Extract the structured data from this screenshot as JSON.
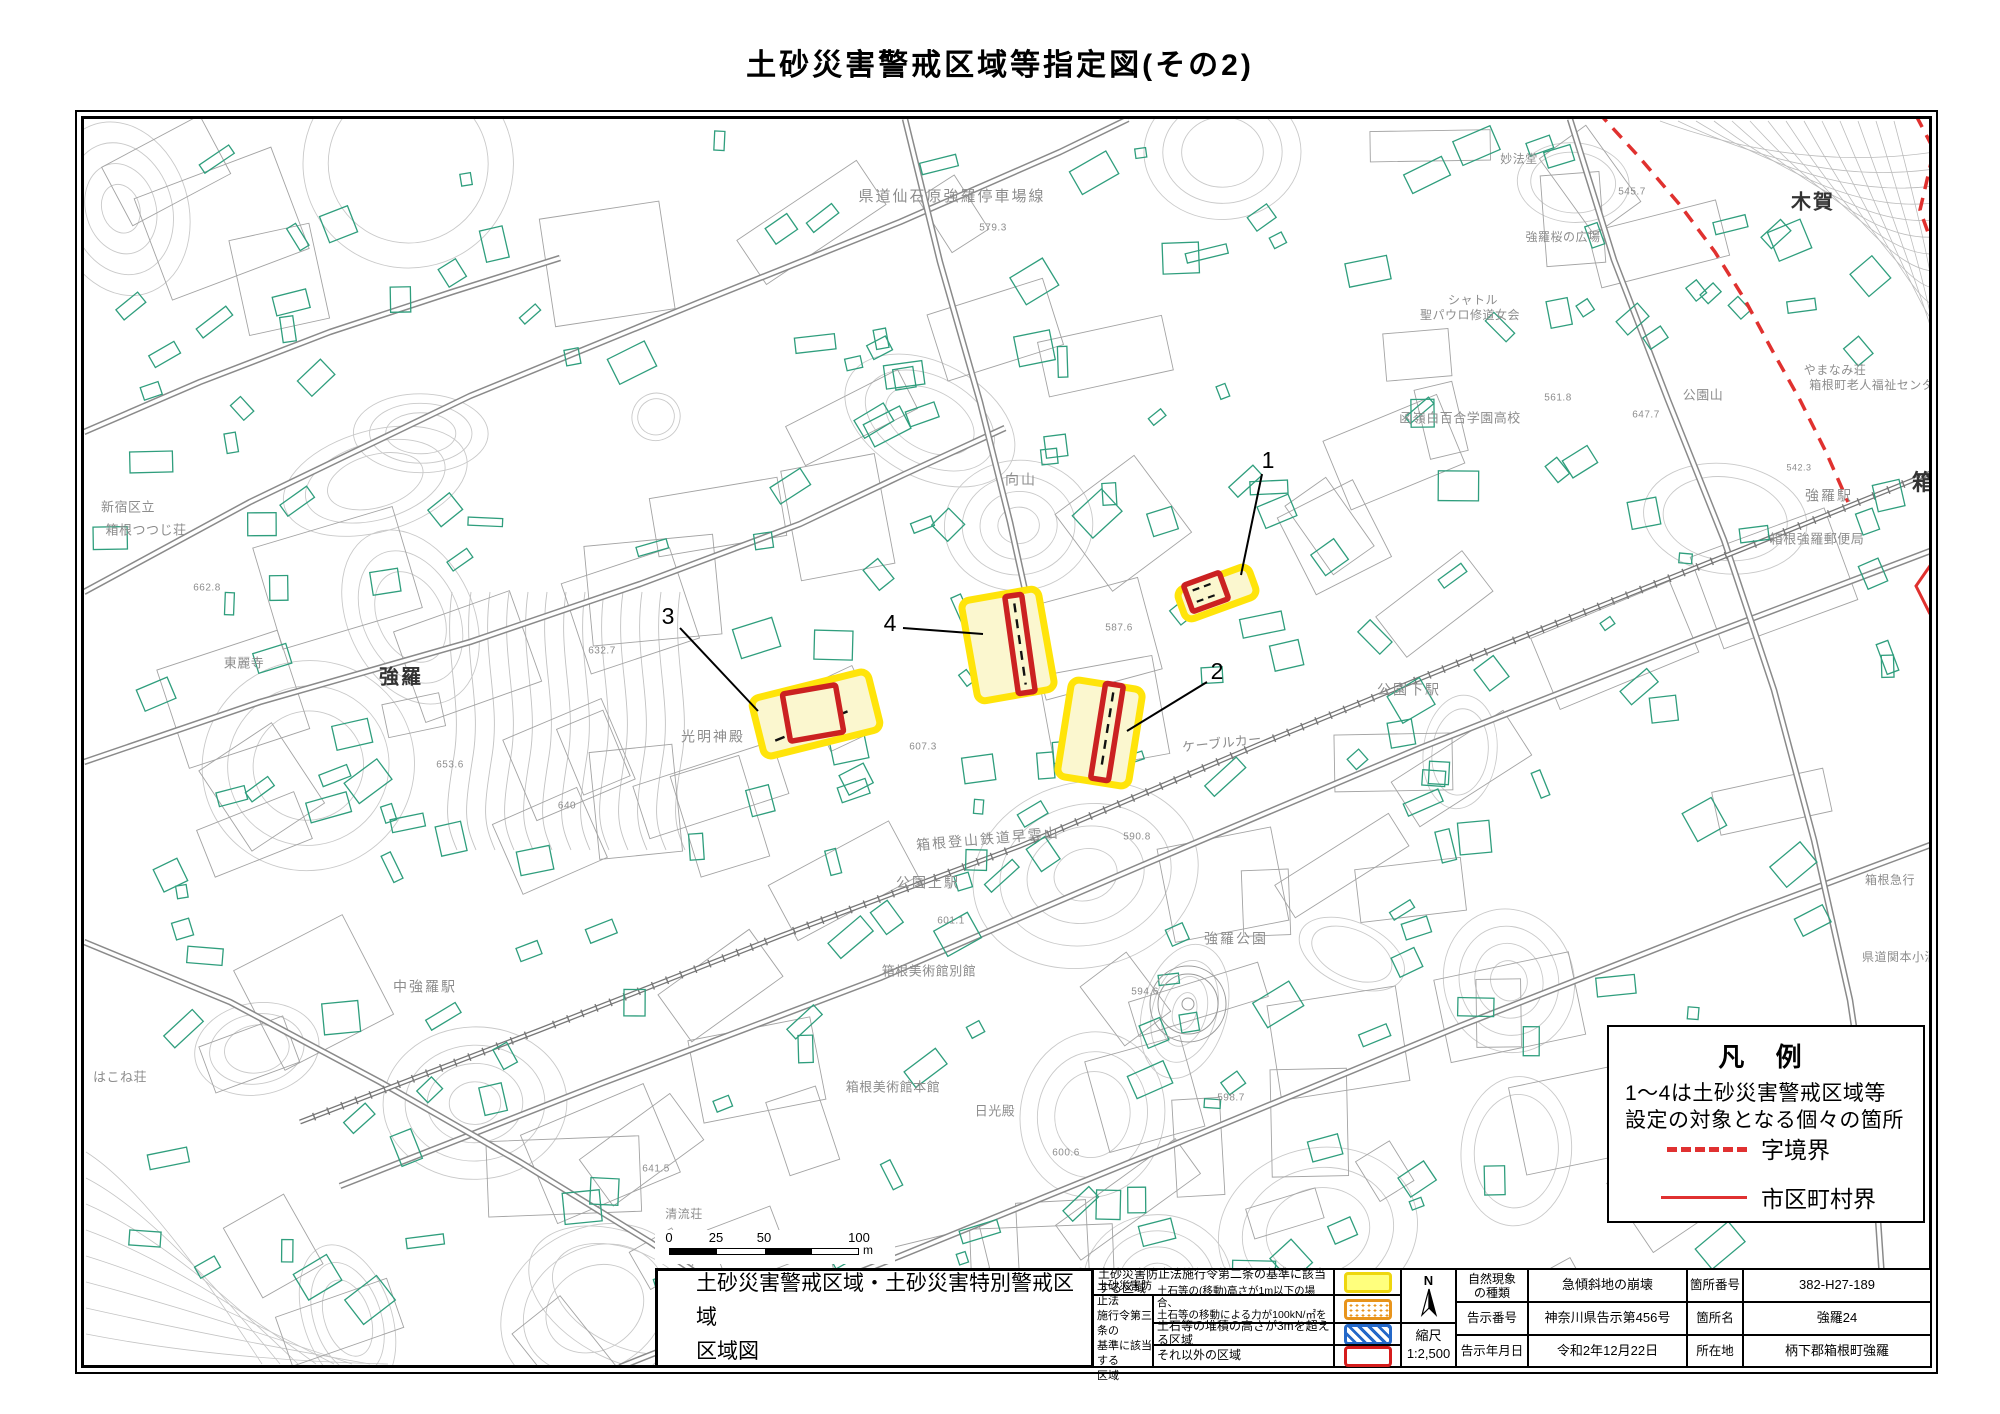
{
  "title": "土砂災害警戒区域等指定図(その2)",
  "legend_box": {
    "title": "凡 例",
    "note_lines": [
      "1〜4は土砂災害警戒区域等",
      "設定の対象となる個々の箇所"
    ],
    "items": [
      {
        "label": "字境界",
        "line": "dashed",
        "color": "#e03131"
      },
      {
        "label": "市区町村界",
        "line": "solid",
        "color": "#e03131"
      }
    ]
  },
  "scale_bar": {
    "t0": "0",
    "t1": "25",
    "t2": "50",
    "t3": "100",
    "unit": "m"
  },
  "info_table": {
    "map_title_lines": [
      "土砂災害警戒区域・土砂災害特別警戒区域",
      "区域図"
    ],
    "article2_label": "土砂災害防止法施行令第二条の基準に該当する区域",
    "article3_group_lines": [
      "土砂災害防止法",
      "施行令第三条の",
      "基準に該当する",
      "区域"
    ],
    "article3_rows": [
      {
        "lines": [
          "土石等の(移動)高さが1m以下の場合、",
          "土石等の移動による力が100kN/㎡を超える区域"
        ],
        "swatch": "orange-dots"
      },
      {
        "lines": [
          "土石等の堆積の高さが3mを超える区域"
        ],
        "swatch": "blue-hatch"
      },
      {
        "lines": [
          "それ以外の区域"
        ],
        "swatch": "red-outline"
      }
    ],
    "compass_label": "N",
    "scale_label": "縮尺",
    "scale_value": "1:2,500",
    "details": [
      {
        "label1_lines": [
          "自然現象",
          "の種類"
        ],
        "value1": "急傾斜地の崩壊",
        "label2": "箇所番号",
        "value2": "382-H27-189"
      },
      {
        "label1_lines": [
          "告示番号"
        ],
        "value1": "神奈川県告示第456号",
        "label2": "箇所名",
        "value2": "強羅24"
      },
      {
        "label1_lines": [
          "告示年月日"
        ],
        "value1": "令和2年12月22日",
        "label2": "所在地",
        "value2": "柄下郡箱根町強羅"
      }
    ]
  },
  "map": {
    "colors": {
      "warning_border": "#ffe40a",
      "warning_fill": "#fbf7cf",
      "special_border": "#cb2121",
      "building": "#2f9e7d",
      "contour": "#c9c9c9",
      "road": "#8a8a8a",
      "boundary_red": "#e0312f",
      "label_gray": "#8d8d8d"
    },
    "area_labels": [
      {
        "t": "県道仙石原強羅停車場線",
        "x": 952,
        "y": 197,
        "s": 15
      },
      {
        "t": "579.3",
        "x": 993,
        "y": 228,
        "s": 10
      },
      {
        "t": "木賀",
        "x": 1813,
        "y": 203,
        "s": 20,
        "c": "#333333",
        "b": 1
      },
      {
        "t": "妙法堂",
        "x": 1519,
        "y": 160,
        "s": 12
      },
      {
        "t": "強羅桜の広場",
        "x": 1563,
        "y": 238,
        "s": 12
      },
      {
        "t": "シャトル",
        "x": 1473,
        "y": 301,
        "s": 12
      },
      {
        "t": "聖パウロ修道女会",
        "x": 1470,
        "y": 316,
        "s": 12
      },
      {
        "t": "新宿区立",
        "x": 128,
        "y": 508,
        "s": 13
      },
      {
        "t": "箱根つつじ荘",
        "x": 146,
        "y": 531,
        "s": 13
      },
      {
        "t": "東麗寺",
        "x": 244,
        "y": 664,
        "s": 13
      },
      {
        "t": "662.8",
        "x": 207,
        "y": 588,
        "s": 10
      },
      {
        "t": "強羅",
        "x": 401,
        "y": 678,
        "s": 20,
        "c": "#333333",
        "b": 1
      },
      {
        "t": "光明神殿",
        "x": 713,
        "y": 738,
        "s": 14
      },
      {
        "t": "向山",
        "x": 1021,
        "y": 481,
        "s": 14
      },
      {
        "t": "函嶺白百合学園高校",
        "x": 1460,
        "y": 419,
        "s": 13
      },
      {
        "t": "公園山",
        "x": 1703,
        "y": 396,
        "s": 13
      },
      {
        "t": "647.7",
        "x": 1646,
        "y": 415,
        "s": 10
      },
      {
        "t": "561.8",
        "x": 1558,
        "y": 398,
        "s": 10
      },
      {
        "t": "545.7",
        "x": 1632,
        "y": 192,
        "s": 10
      },
      {
        "t": "やまなみ荘",
        "x": 1835,
        "y": 371,
        "s": 12
      },
      {
        "t": "箱根町老人福祉センター",
        "x": 1878,
        "y": 386,
        "s": 12
      },
      {
        "t": "強羅駅",
        "x": 1829,
        "y": 497,
        "s": 14
      },
      {
        "t": "542.3",
        "x": 1799,
        "y": 468,
        "s": 9
      },
      {
        "t": "箱根強羅郵便局",
        "x": 1817,
        "y": 540,
        "s": 13
      },
      {
        "t": "箱根",
        "x": 1936,
        "y": 484,
        "s": 22,
        "c": "#333333",
        "b": 1
      },
      {
        "t": "公園下駅",
        "x": 1409,
        "y": 691,
        "s": 14
      },
      {
        "t": "ケーブルカー",
        "x": 1222,
        "y": 744,
        "s": 13,
        "r": -6
      },
      {
        "t": "587.6",
        "x": 1119,
        "y": 628,
        "s": 10
      },
      {
        "t": "箱根登山鉄道早雲山",
        "x": 988,
        "y": 840,
        "s": 14,
        "r": -5
      },
      {
        "t": "公園上駅",
        "x": 928,
        "y": 884,
        "s": 14
      },
      {
        "t": "601.1",
        "x": 951,
        "y": 921,
        "s": 10
      },
      {
        "t": "590.8",
        "x": 1137,
        "y": 837,
        "s": 10
      },
      {
        "t": "強羅公園",
        "x": 1236,
        "y": 940,
        "s": 14
      },
      {
        "t": "594.6",
        "x": 1145,
        "y": 992,
        "s": 10
      },
      {
        "t": "箱根美術館別館",
        "x": 929,
        "y": 972,
        "s": 13
      },
      {
        "t": "箱根美術館本館",
        "x": 893,
        "y": 1088,
        "s": 13
      },
      {
        "t": "日光殿",
        "x": 995,
        "y": 1112,
        "s": 13
      },
      {
        "t": "598.7",
        "x": 1231,
        "y": 1098,
        "s": 10
      },
      {
        "t": "600.6",
        "x": 1066,
        "y": 1153,
        "s": 10
      },
      {
        "t": "中強羅駅",
        "x": 425,
        "y": 988,
        "s": 14
      },
      {
        "t": "はこね荘",
        "x": 120,
        "y": 1078,
        "s": 13
      },
      {
        "t": "清流荘",
        "x": 684,
        "y": 1215,
        "s": 12
      },
      {
        "t": "641.5",
        "x": 656,
        "y": 1169,
        "s": 10
      },
      {
        "t": "県道関本小涌谷線",
        "x": 1912,
        "y": 958,
        "s": 12
      },
      {
        "t": "箱根急行",
        "x": 1890,
        "y": 881,
        "s": 12
      },
      {
        "t": "632.7",
        "x": 602,
        "y": 651,
        "s": 10
      },
      {
        "t": "653.6",
        "x": 450,
        "y": 765,
        "s": 10
      },
      {
        "t": "640",
        "x": 567,
        "y": 806,
        "s": 10
      },
      {
        "t": "607.3",
        "x": 923,
        "y": 747,
        "s": 10
      }
    ],
    "hazard_zones": [
      {
        "id": "1",
        "yellow": {
          "cx": 1217,
          "cy": 593,
          "w": 76,
          "h": 32,
          "rot": -20
        },
        "red": {
          "cx": 1206,
          "cy": 592,
          "w": 38,
          "h": 28,
          "rot": -20
        },
        "dash": "h2"
      },
      {
        "id": "2",
        "yellow": {
          "cx": 1100,
          "cy": 733,
          "w": 72,
          "h": 98,
          "rot": 9
        },
        "red": {
          "cx": 1107,
          "cy": 732,
          "w": 18,
          "h": 96,
          "rot": 9
        },
        "dash": "v"
      },
      {
        "id": "3",
        "yellow": {
          "cx": 816,
          "cy": 714,
          "w": 120,
          "h": 60,
          "rot": -14
        },
        "red": {
          "cx": 813,
          "cy": 713,
          "w": 54,
          "h": 48,
          "rot": -10
        },
        "dash": "cross3"
      },
      {
        "id": "4",
        "yellow": {
          "cx": 1008,
          "cy": 645,
          "w": 78,
          "h": 102,
          "rot": -10
        },
        "red": {
          "cx": 1020,
          "cy": 644,
          "w": 17,
          "h": 98,
          "rot": -8
        },
        "dash": "v"
      }
    ],
    "markers": [
      {
        "n": "1",
        "tx": 1268,
        "ty": 462,
        "x1": 1262,
        "y1": 474,
        "x2": 1241,
        "y2": 575
      },
      {
        "n": "2",
        "tx": 1217,
        "ty": 673,
        "x1": 1207,
        "y1": 682,
        "x2": 1127,
        "y2": 731
      },
      {
        "n": "3",
        "tx": 668,
        "ty": 618,
        "x1": 680,
        "y1": 628,
        "x2": 758,
        "y2": 711
      },
      {
        "n": "4",
        "tx": 890,
        "ty": 625,
        "x1": 903,
        "y1": 628,
        "x2": 983,
        "y2": 634
      }
    ]
  }
}
